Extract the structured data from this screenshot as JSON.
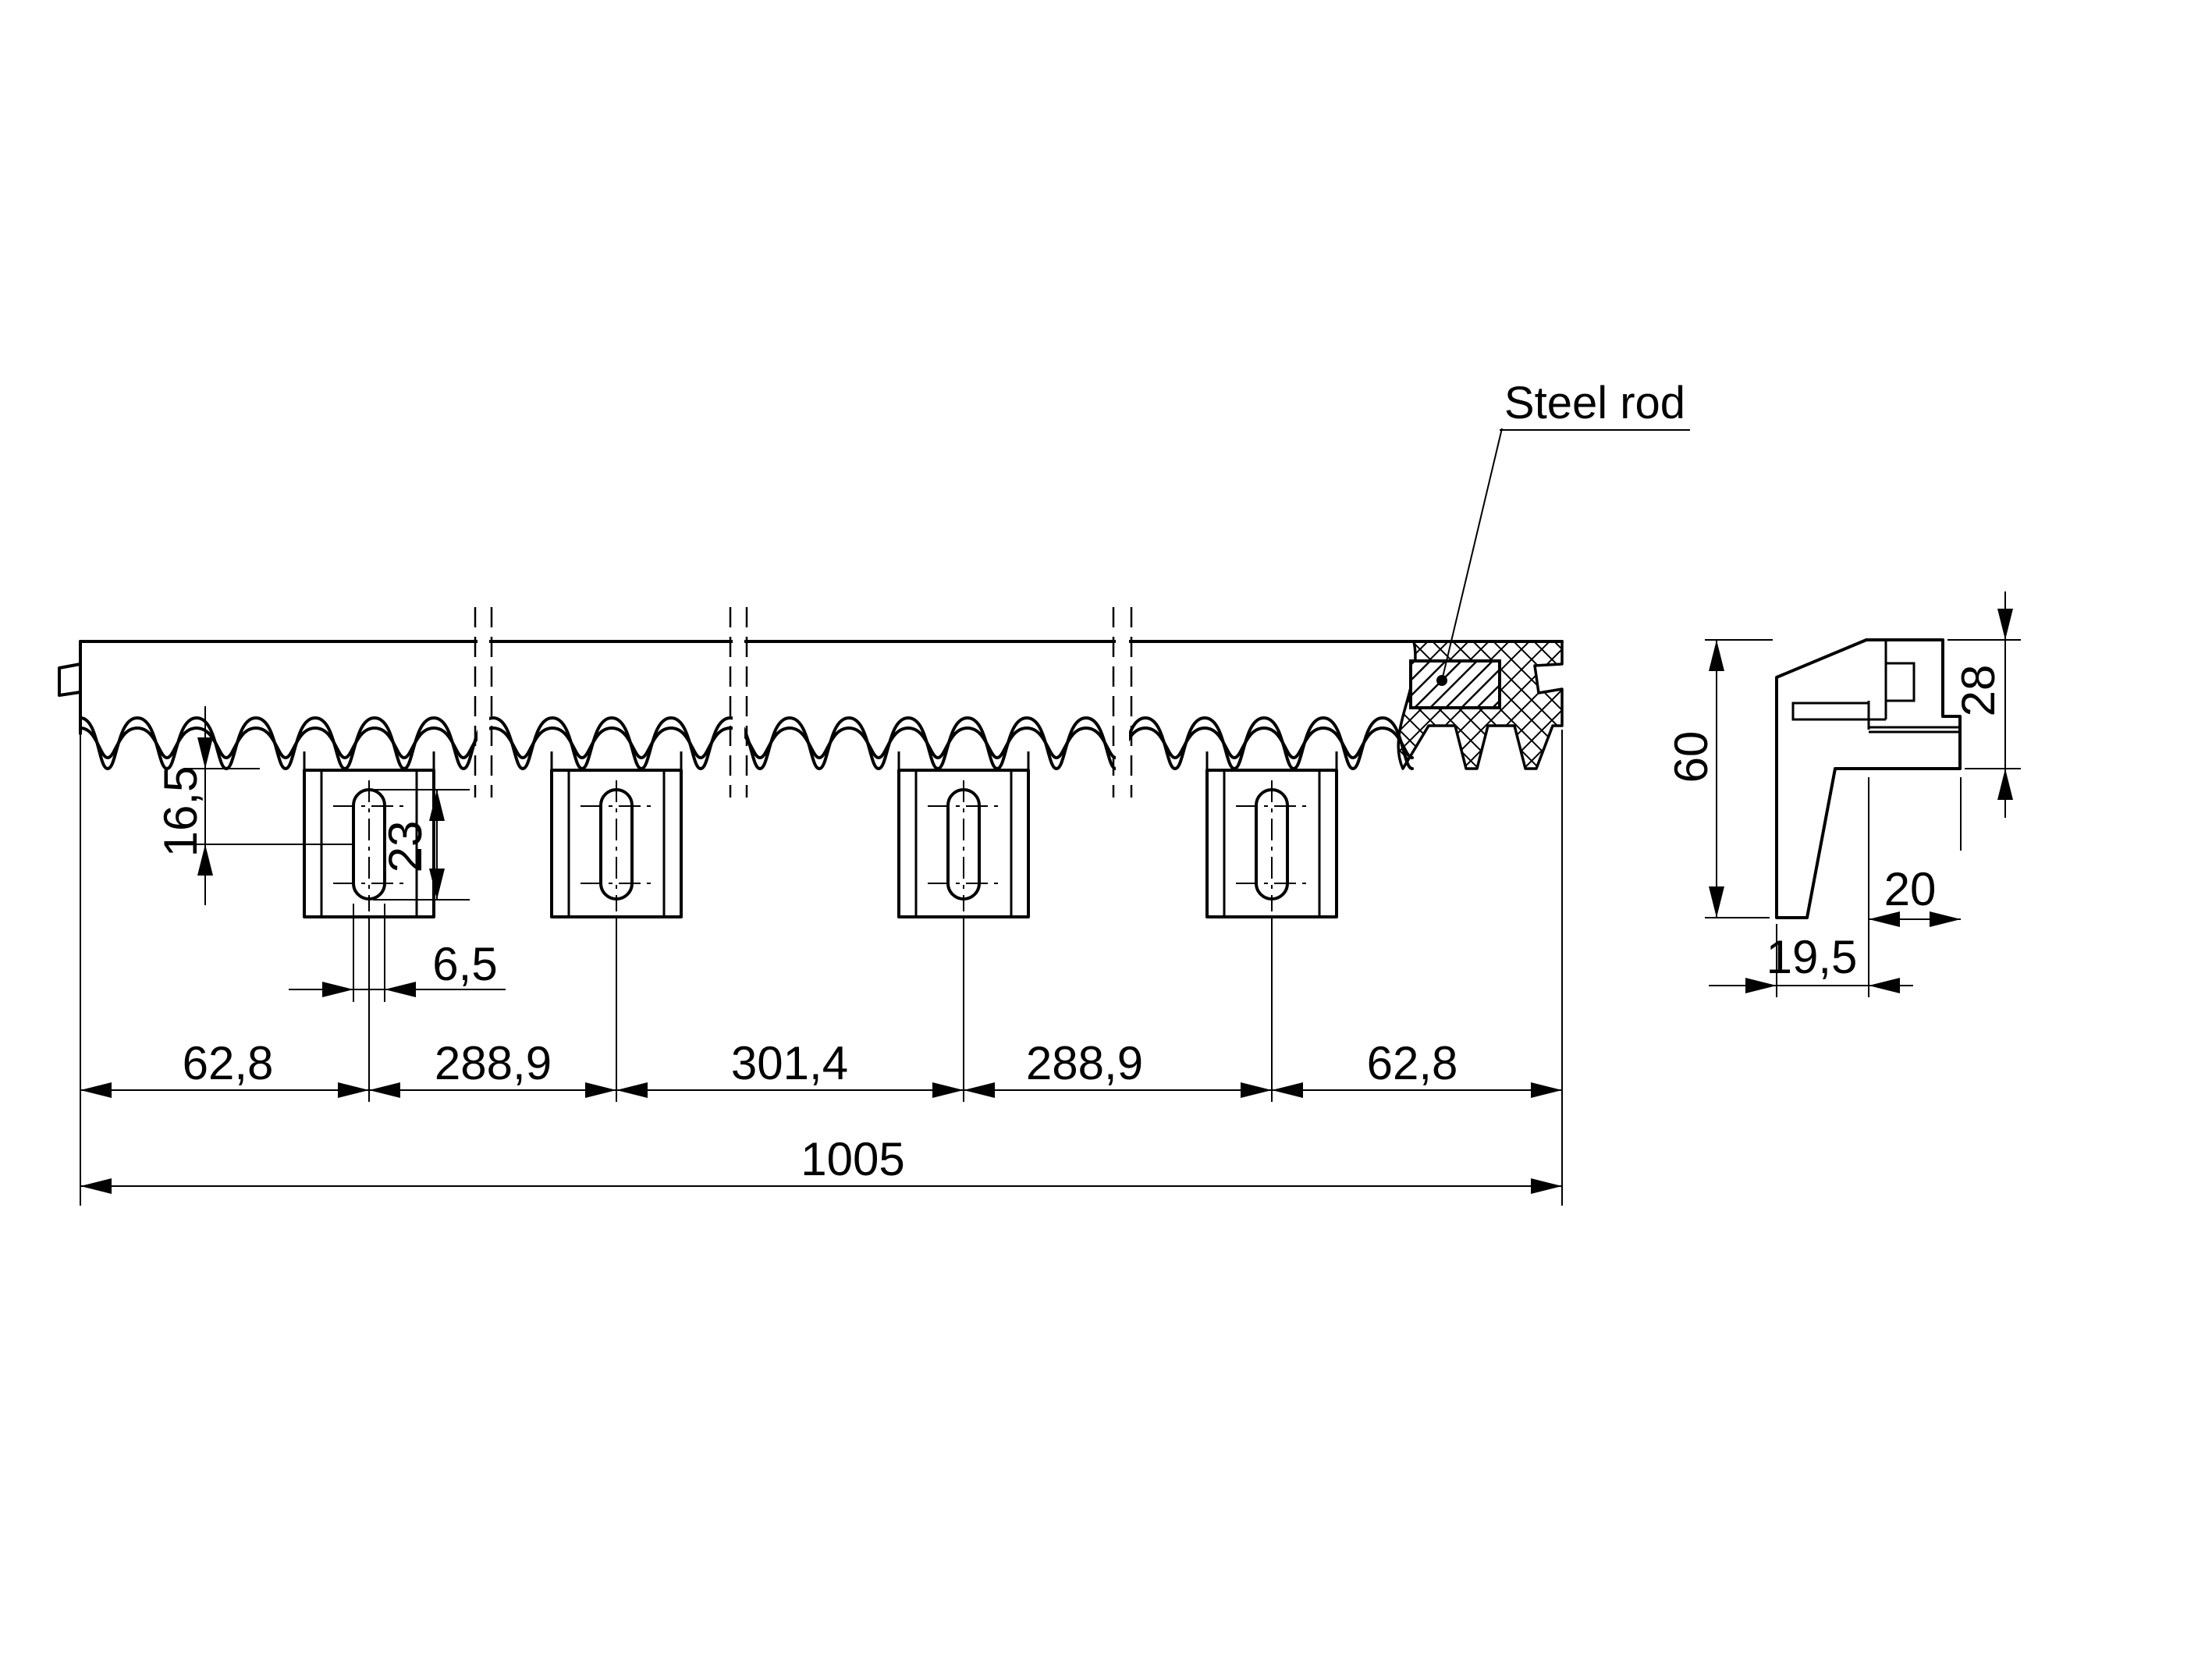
{
  "drawing": {
    "title_callout": "Steel rod",
    "dimensions": {
      "chain": [
        "62,8",
        "288,9",
        "301,4",
        "288,9",
        "62,8"
      ],
      "total_length": "1005",
      "tooth_root_to_slot_center": "16,5",
      "slot_length": "23",
      "slot_width": "6,5",
      "profile_height": "60",
      "tooth_zone_height": "28",
      "profile_depth": "20",
      "foot_width": "19,5"
    },
    "colors": {
      "line": "#000000",
      "background": "#ffffff"
    }
  }
}
